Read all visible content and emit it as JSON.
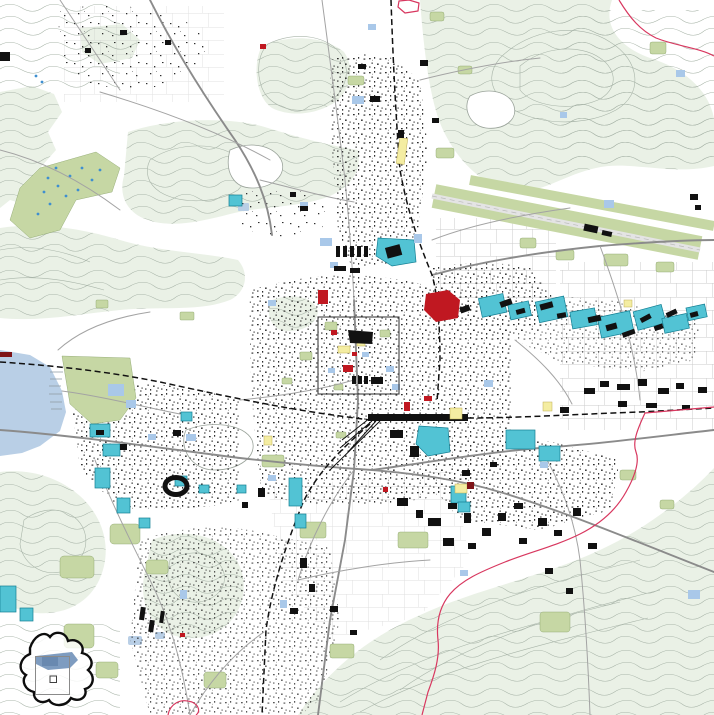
{
  "palette": {
    "background": "#ffffff",
    "hill": "#eaf1e6",
    "contour": "#a9b5a9",
    "water": "#b9cfe6",
    "green": "#c6d7a4",
    "greenline": "#85a065",
    "teal": "#52c3d4",
    "tealline": "#137f93",
    "bld": "#111111",
    "redbld": "#c01821",
    "darkred": "#7e1418",
    "yellow": "#f4eda2",
    "yellowline": "#bfae52",
    "bluelot": "#a9c8e9",
    "road": "#a3a3a3",
    "roadmain": "#8b8b8b",
    "rail": "#111111",
    "boundary": "#d8375f",
    "parcelline": "#bdbdbd",
    "speck": "#1c1c1c",
    "insetLake": "#7e9cc0",
    "insetLakeDark": "#5d7fa8",
    "insetOutline": "#0d0d0d",
    "extentRect": "#8a8a8a",
    "detailFrame": "#3f3f3f",
    "golfDot": "#3e8fd0",
    "runway": "#e4e4e4"
  },
  "map": {
    "kind": "topographic-city-overview-map",
    "features": [
      "forested-hills-with-contours",
      "lake-west-shore",
      "city-centre-detail-frame",
      "railway-lines",
      "municipal-boundary-red",
      "highlighted-teal-districts",
      "parks-and-green-areas",
      "airport-runway-strip",
      "golf-course-with-ponds",
      "stadium-ring",
      "building-footprints"
    ]
  },
  "inset": {
    "elements": [
      "municipality-outline",
      "lake-area",
      "map-extent-rectangle",
      "detail-square"
    ]
  }
}
